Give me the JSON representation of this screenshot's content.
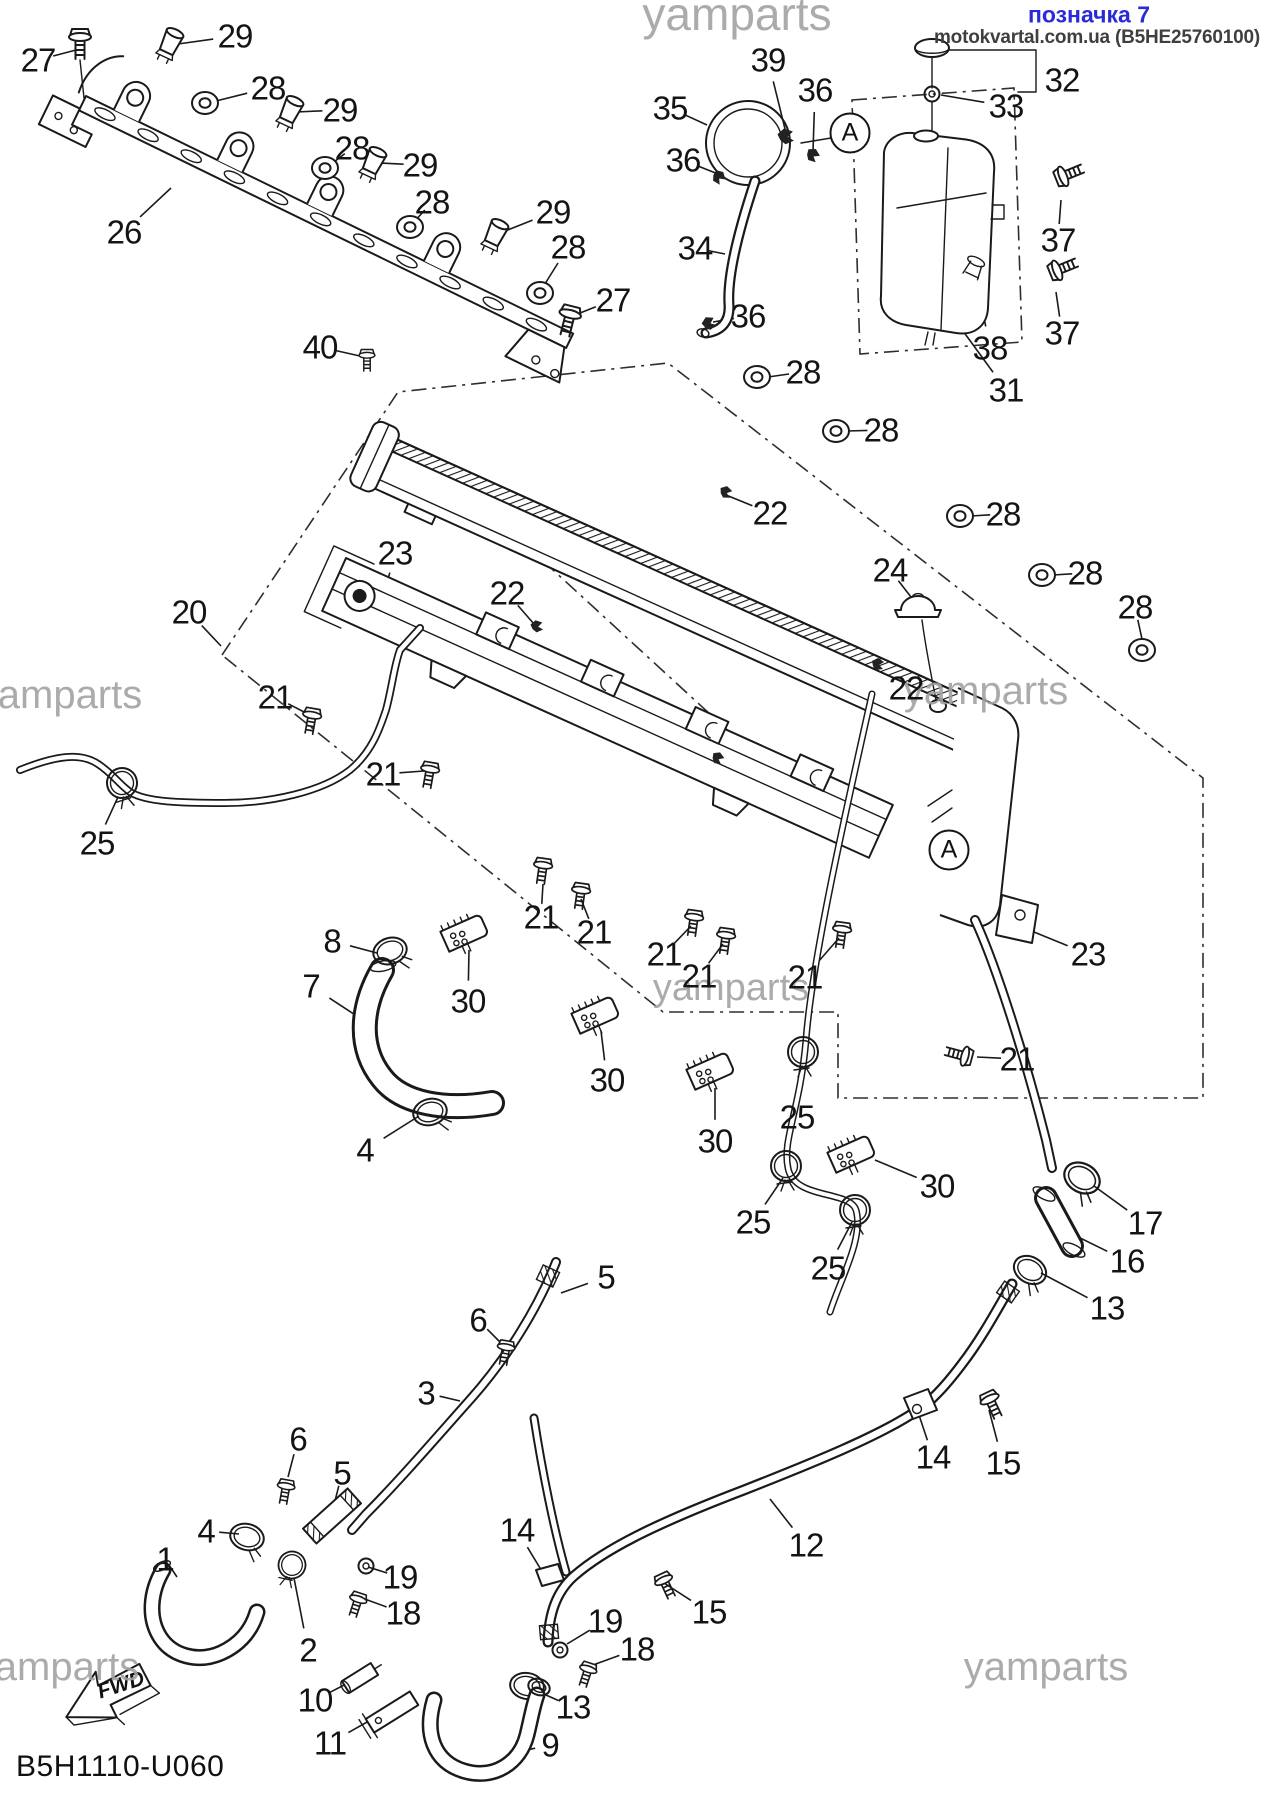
{
  "header": {
    "tag": "позначка 7",
    "tag_color": "#2a2ad9",
    "source": "motokvartal.com.ua (B5HE25760100)",
    "source_color": "#3f3f3f"
  },
  "footer": {
    "drawing_code": "B5H1110-U060",
    "fwd_label": "FWD"
  },
  "watermark_text": "yamparts",
  "watermarks": [
    {
      "x": 737,
      "y": 14,
      "size": 46
    },
    {
      "x": 60,
      "y": 695,
      "size": 40
    },
    {
      "x": 986,
      "y": 691,
      "size": 40
    },
    {
      "x": 731,
      "y": 988,
      "size": 38
    },
    {
      "x": 57,
      "y": 1667,
      "size": 40
    },
    {
      "x": 1046,
      "y": 1667,
      "size": 40
    }
  ],
  "circled_markers": [
    {
      "label": "A",
      "x": 850,
      "y": 133
    },
    {
      "label": "A",
      "x": 949,
      "y": 850
    }
  ],
  "part_labels": [
    {
      "n": "27",
      "x": 38,
      "y": 60,
      "tx": 76,
      "ty": 50
    },
    {
      "n": "29",
      "x": 235,
      "y": 36,
      "tx": 178,
      "ty": 44
    },
    {
      "n": "28",
      "x": 268,
      "y": 88,
      "tx": 216,
      "ty": 101
    },
    {
      "n": "29",
      "x": 340,
      "y": 110,
      "tx": 296,
      "ty": 112
    },
    {
      "n": "28",
      "x": 352,
      "y": 148,
      "tx": 334,
      "ty": 162
    },
    {
      "n": "29",
      "x": 420,
      "y": 165,
      "tx": 379,
      "ty": 163
    },
    {
      "n": "28",
      "x": 432,
      "y": 202,
      "tx": 414,
      "ty": 222
    },
    {
      "n": "29",
      "x": 553,
      "y": 212,
      "tx": 500,
      "ty": 233
    },
    {
      "n": "28",
      "x": 568,
      "y": 247,
      "tx": 543,
      "ty": 287
    },
    {
      "n": "26",
      "x": 124,
      "y": 232,
      "tx": 171,
      "ty": 188
    },
    {
      "n": "40",
      "x": 320,
      "y": 347,
      "tx": 360,
      "ty": 356
    },
    {
      "n": "27",
      "x": 613,
      "y": 300,
      "tx": 570,
      "ty": 317
    },
    {
      "n": "39",
      "x": 768,
      "y": 60,
      "tx": 786,
      "ty": 133
    },
    {
      "n": "36",
      "x": 815,
      "y": 90,
      "tx": 813,
      "ty": 151
    },
    {
      "n": "35",
      "x": 670,
      "y": 108,
      "tx": 707,
      "ty": 125
    },
    {
      "n": "36",
      "x": 683,
      "y": 160,
      "tx": 718,
      "ty": 174
    },
    {
      "n": "34",
      "x": 695,
      "y": 248,
      "tx": 725,
      "ty": 254
    },
    {
      "n": "36",
      "x": 748,
      "y": 316,
      "tx": 713,
      "ty": 322
    },
    {
      "n": "32",
      "x": 1062,
      "y": 80
    },
    {
      "n": "33",
      "x": 1006,
      "y": 106,
      "tx": 941,
      "ty": 95
    },
    {
      "n": "37",
      "x": 1058,
      "y": 240,
      "tx": 1061,
      "ty": 200
    },
    {
      "n": "38",
      "x": 990,
      "y": 348,
      "tx": 976,
      "ty": 277
    },
    {
      "n": "37",
      "x": 1062,
      "y": 333,
      "tx": 1056,
      "ty": 292
    },
    {
      "n": "31",
      "x": 1006,
      "y": 390,
      "tx": 963,
      "ty": 331
    },
    {
      "n": "28",
      "x": 803,
      "y": 372,
      "tx": 768,
      "ty": 377
    },
    {
      "n": "28",
      "x": 881,
      "y": 430,
      "tx": 847,
      "ty": 431
    },
    {
      "n": "22",
      "x": 770,
      "y": 513,
      "tx": 726,
      "ty": 495
    },
    {
      "n": "28",
      "x": 1003,
      "y": 514,
      "tx": 971,
      "ty": 516
    },
    {
      "n": "24",
      "x": 890,
      "y": 570,
      "tx": 911,
      "ty": 597
    },
    {
      "n": "28",
      "x": 1085,
      "y": 573,
      "tx": 1053,
      "ty": 575
    },
    {
      "n": "28",
      "x": 1135,
      "y": 607,
      "tx": 1142,
      "ty": 639
    },
    {
      "n": "22",
      "x": 906,
      "y": 688,
      "tx": 878,
      "ty": 666
    },
    {
      "n": "22",
      "x": 507,
      "y": 593,
      "tx": 534,
      "ty": 624
    },
    {
      "n": "23",
      "x": 395,
      "y": 553,
      "tx": 382,
      "ty": 602
    },
    {
      "n": "20",
      "x": 189,
      "y": 612,
      "tx": 221,
      "ty": 646
    },
    {
      "n": "21",
      "x": 275,
      "y": 697,
      "tx": 308,
      "ty": 714
    },
    {
      "n": "21",
      "x": 383,
      "y": 774,
      "tx": 424,
      "ty": 771
    },
    {
      "n": "21",
      "x": 541,
      "y": 917,
      "tx": 543,
      "ty": 884
    },
    {
      "n": "21",
      "x": 594,
      "y": 932,
      "tx": 581,
      "ty": 899
    },
    {
      "n": "21",
      "x": 664,
      "y": 954,
      "tx": 691,
      "ty": 926
    },
    {
      "n": "21",
      "x": 699,
      "y": 976,
      "tx": 723,
      "ty": 944
    },
    {
      "n": "21",
      "x": 805,
      "y": 977,
      "tx": 839,
      "ty": 938
    },
    {
      "n": "21",
      "x": 1017,
      "y": 1059,
      "tx": 977,
      "ty": 1057
    },
    {
      "n": "23",
      "x": 1088,
      "y": 954,
      "tx": 1034,
      "ty": 932
    },
    {
      "n": "30",
      "x": 468,
      "y": 1001,
      "tx": 469,
      "ty": 950
    },
    {
      "n": "30",
      "x": 607,
      "y": 1080,
      "tx": 601,
      "ty": 1031
    },
    {
      "n": "30",
      "x": 715,
      "y": 1141,
      "tx": 715,
      "ty": 1088
    },
    {
      "n": "30",
      "x": 937,
      "y": 1186,
      "tx": 875,
      "ty": 1160
    },
    {
      "n": "25",
      "x": 97,
      "y": 843,
      "tx": 118,
      "ty": 797
    },
    {
      "n": "25",
      "x": 797,
      "y": 1117,
      "tx": 803,
      "ty": 1066
    },
    {
      "n": "25",
      "x": 753,
      "y": 1222,
      "tx": 783,
      "ty": 1178
    },
    {
      "n": "25",
      "x": 828,
      "y": 1268,
      "tx": 852,
      "ty": 1222
    },
    {
      "n": "8",
      "x": 332,
      "y": 941,
      "tx": 377,
      "ty": 953
    },
    {
      "n": "7",
      "x": 311,
      "y": 986,
      "tx": 366,
      "ty": 1022
    },
    {
      "n": "4",
      "x": 365,
      "y": 1150,
      "tx": 419,
      "ty": 1116
    },
    {
      "n": "5",
      "x": 606,
      "y": 1277,
      "tx": 561,
      "ty": 1293
    },
    {
      "n": "6",
      "x": 478,
      "y": 1320,
      "tx": 501,
      "ty": 1343
    },
    {
      "n": "3",
      "x": 426,
      "y": 1393,
      "tx": 460,
      "ty": 1401
    },
    {
      "n": "6",
      "x": 298,
      "y": 1439,
      "tx": 288,
      "ty": 1477
    },
    {
      "n": "5",
      "x": 342,
      "y": 1473,
      "tx": 334,
      "ty": 1505
    },
    {
      "n": "4",
      "x": 206,
      "y": 1531,
      "tx": 239,
      "ty": 1534
    },
    {
      "n": "1",
      "x": 165,
      "y": 1559,
      "tx": 177,
      "ty": 1577
    },
    {
      "n": "19",
      "x": 400,
      "y": 1577,
      "tx": 368,
      "ty": 1567
    },
    {
      "n": "18",
      "x": 403,
      "y": 1613,
      "tx": 362,
      "ty": 1598
    },
    {
      "n": "2",
      "x": 308,
      "y": 1650,
      "tx": 294,
      "ty": 1578
    },
    {
      "n": "10",
      "x": 315,
      "y": 1700,
      "tx": 350,
      "ty": 1682
    },
    {
      "n": "11",
      "x": 330,
      "y": 1743,
      "tx": 376,
      "ty": 1717
    },
    {
      "n": "9",
      "x": 550,
      "y": 1745,
      "tx": 513,
      "ty": 1753
    },
    {
      "n": "13",
      "x": 573,
      "y": 1707,
      "tx": 537,
      "ty": 1691
    },
    {
      "n": "19",
      "x": 605,
      "y": 1621,
      "tx": 567,
      "ty": 1644
    },
    {
      "n": "18",
      "x": 637,
      "y": 1649,
      "tx": 593,
      "ty": 1665
    },
    {
      "n": "15",
      "x": 709,
      "y": 1612,
      "tx": 664,
      "ty": 1583
    },
    {
      "n": "14",
      "x": 517,
      "y": 1530,
      "tx": 543,
      "ty": 1573
    },
    {
      "n": "12",
      "x": 806,
      "y": 1545,
      "tx": 770,
      "ty": 1499
    },
    {
      "n": "14",
      "x": 933,
      "y": 1457,
      "tx": 919,
      "ty": 1415
    },
    {
      "n": "15",
      "x": 1003,
      "y": 1463,
      "tx": 989,
      "ty": 1410
    },
    {
      "n": "17",
      "x": 1145,
      "y": 1223,
      "tx": 1094,
      "ty": 1186
    },
    {
      "n": "16",
      "x": 1127,
      "y": 1261,
      "tx": 1070,
      "ty": 1233
    },
    {
      "n": "13",
      "x": 1107,
      "y": 1308,
      "tx": 1041,
      "ty": 1273
    }
  ]
}
